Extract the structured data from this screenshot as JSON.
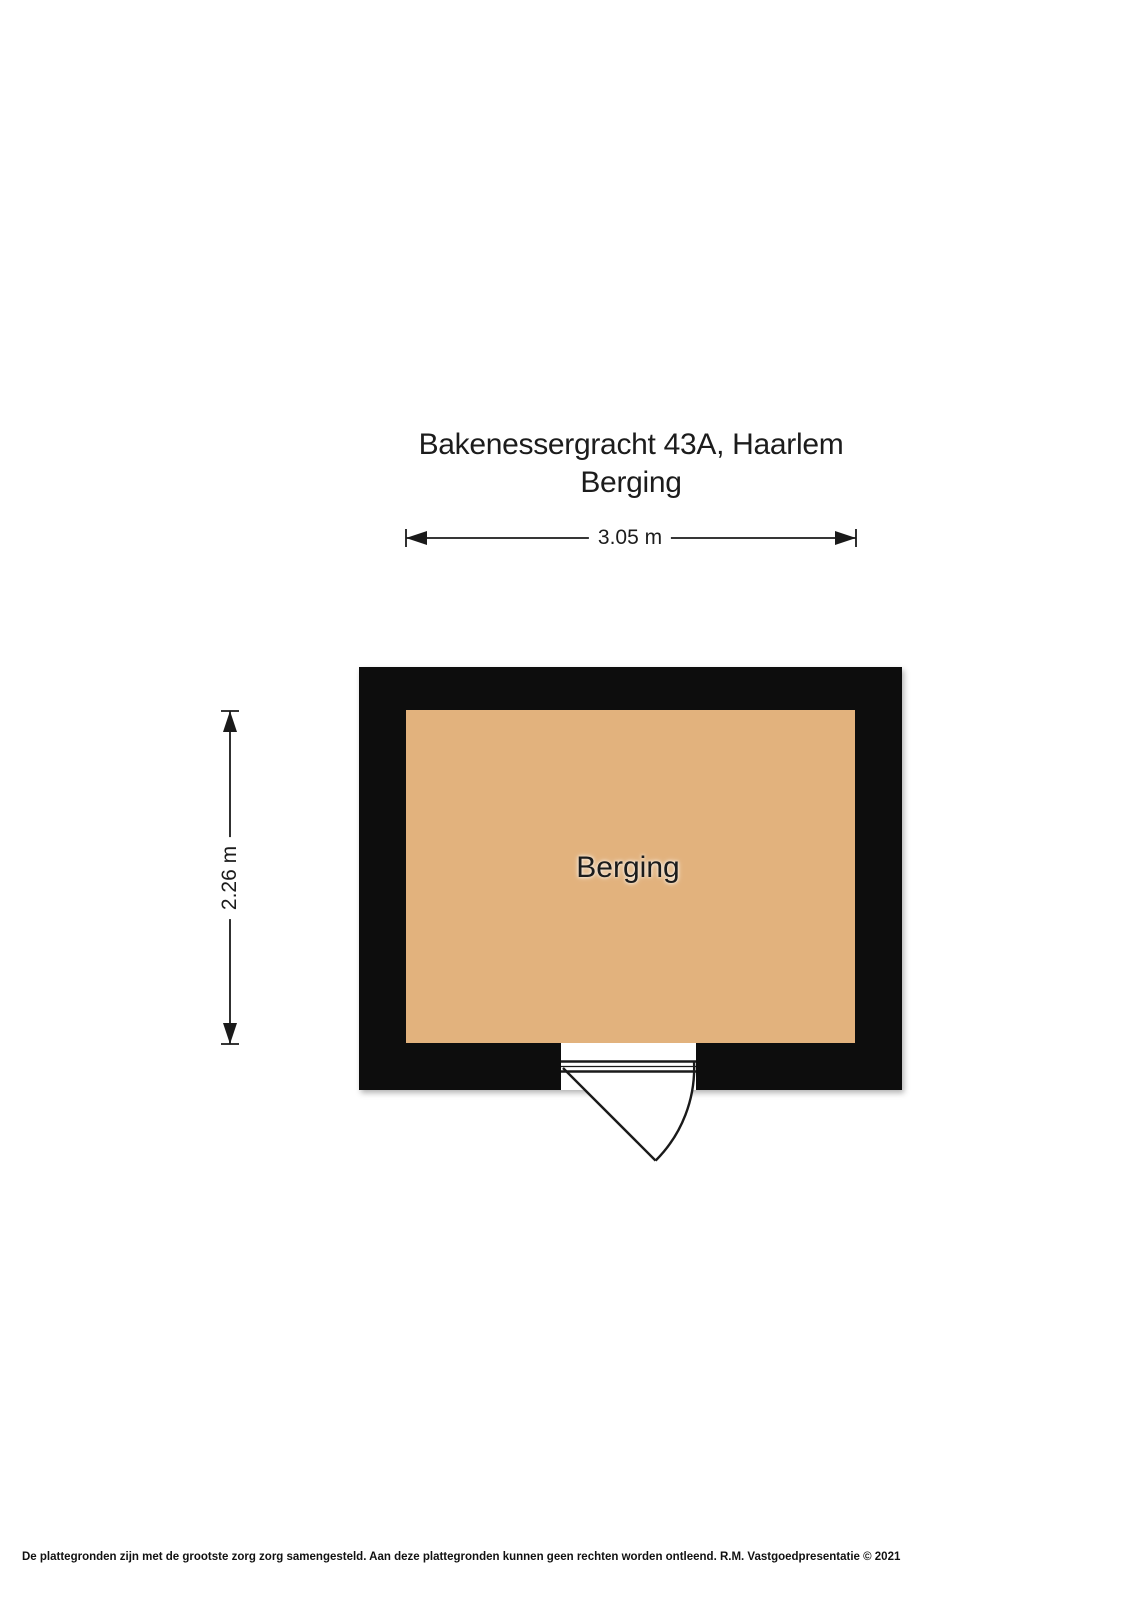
{
  "header": {
    "title": "Bakenessergracht 43A, Haarlem",
    "subtitle": "Berging"
  },
  "floorplan": {
    "room_label": "Berging",
    "width_dimension": "3.05 m",
    "height_dimension": "2.26 m",
    "colors": {
      "wall": "#0d0d0d",
      "floor": "#e2b27d",
      "line": "#1a1a1a",
      "background": "#ffffff"
    }
  },
  "footer": {
    "disclaimer": "De plattegronden zijn met de grootste zorg zorg samengesteld. Aan deze plattegronden kunnen geen rechten worden ontleend. R.M. Vastgoedpresentatie © 2021"
  }
}
